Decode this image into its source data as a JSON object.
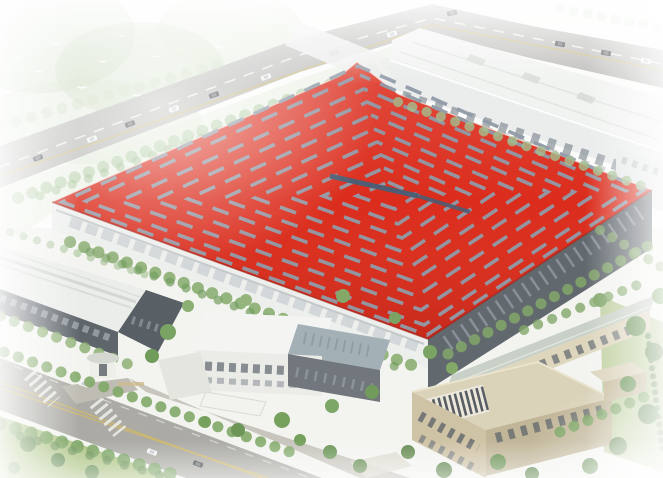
{
  "scene": {
    "type": "architectural-aerial-rendering",
    "subject": "factory campus with large red-roof production hall",
    "elements": [
      "flock-of-birds",
      "highway-with-cars",
      "background-factory-hall",
      "red-roof-production-hall",
      "skylight-dash-strips",
      "west-warehouse",
      "office-building-with-atrium",
      "security-gatehouse",
      "green-roof-workshop",
      "beige-annex-with-solar-panels",
      "front-road-with-crosswalks",
      "tree-rows",
      "lawns"
    ]
  },
  "colors": {
    "roof_red": "#da2110",
    "skylight_dash": "#8b96a4",
    "skylight_ridge_strip": "#44556c",
    "highway_asphalt": "#b4b3b0",
    "front_road_asphalt": "#a7a6a0",
    "lane_yellow": "#d2b85c",
    "background_building_wall": "#e9eceb",
    "main_building_front_wall": "#edefed",
    "main_building_side_wall": "#5a6167",
    "warehouse_roof": "#eaede9",
    "office_glass": "#9fadb3",
    "workshop_roof": "#c6cec4",
    "annex_wall": "#cdc0a1",
    "solar_panels": "#3e454c",
    "tree_light": "#b7cfaa",
    "tree_mid": "#85aa6b",
    "tree_dark": "#5d8749",
    "lawn_green": "#aac27f",
    "bird_white": "#ffffff",
    "haze_white": "#ffffff"
  }
}
